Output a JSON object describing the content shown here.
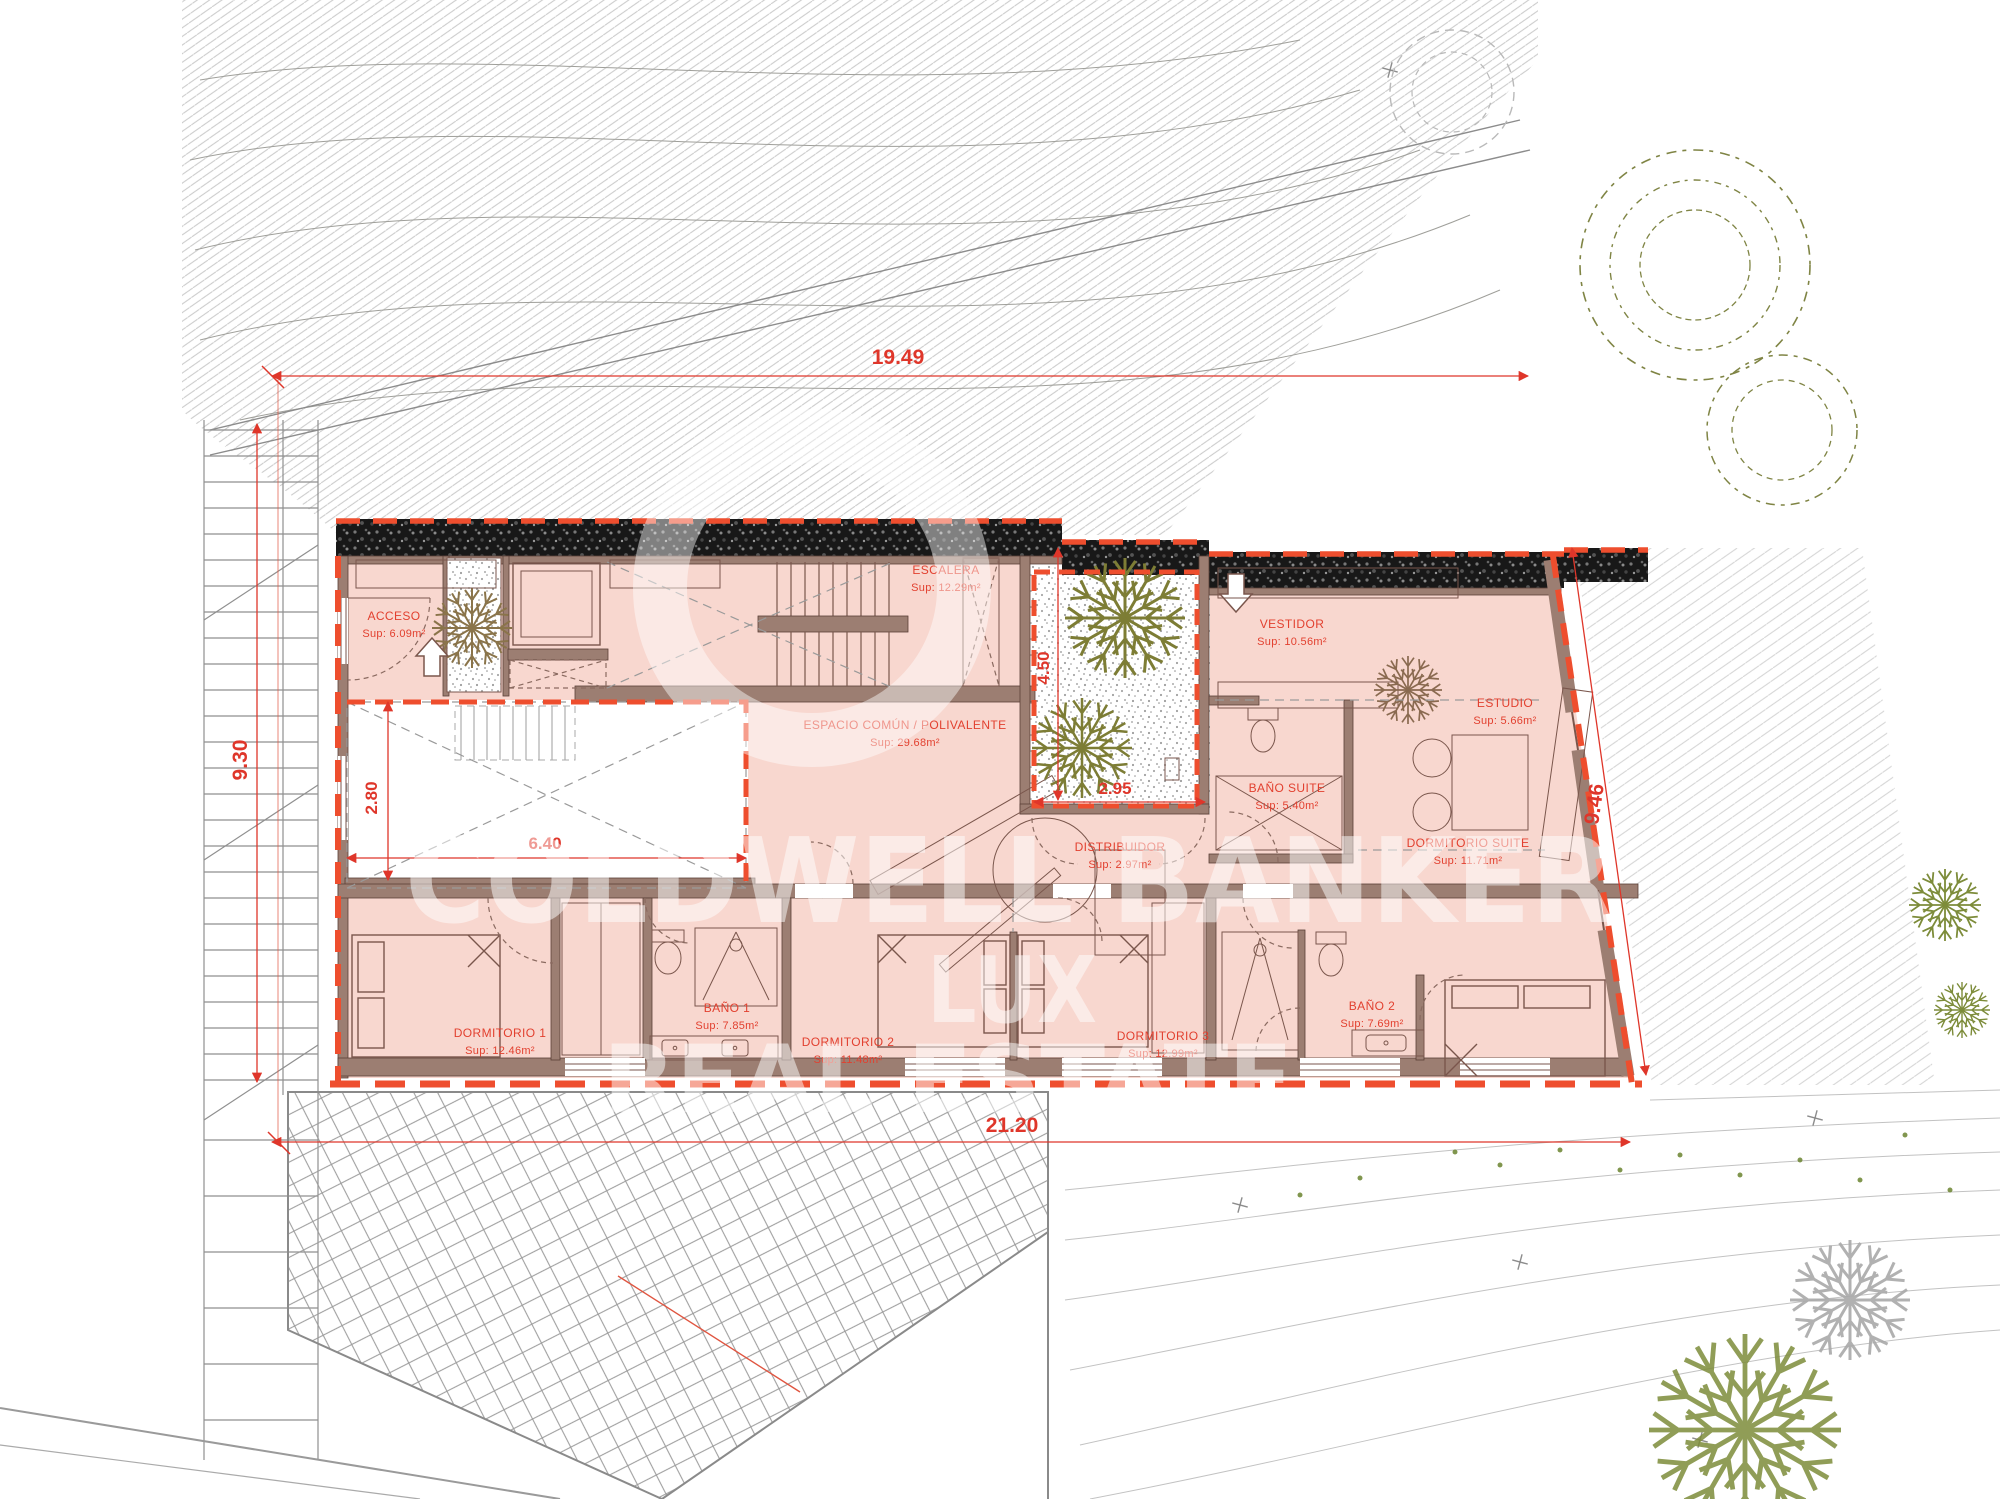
{
  "plan": {
    "watermark": {
      "line1": "COLDWELL BANKER",
      "line2": "LUX",
      "line3": "REAL ESTATE"
    },
    "rooms": [
      {
        "name": "ACCESO",
        "sup": "Sup: 6.09m²"
      },
      {
        "name": "ESCALERA",
        "sup": "Sup: 12.29m²"
      },
      {
        "name": "ESPACIO COMÚN / POLIVALENTE",
        "sup": "Sup: 29.68m²"
      },
      {
        "name": "VESTIDOR",
        "sup": "Sup: 10.56m²"
      },
      {
        "name": "ESTUDIO",
        "sup": "Sup: 5.66m²"
      },
      {
        "name": "BAÑO SUITE",
        "sup": "Sup: 5.40m²"
      },
      {
        "name": "DORMITORIO SUITE",
        "sup": "Sup: 11.71m²"
      },
      {
        "name": "DISTRIBUIDOR",
        "sup": "Sup: 2.97m²"
      },
      {
        "name": "DORMITORIO 1",
        "sup": "Sup: 12.46m²"
      },
      {
        "name": "BAÑO 1",
        "sup": "Sup: 7.85m²"
      },
      {
        "name": "DORMITORIO 2",
        "sup": "Sup: 11.48m²"
      },
      {
        "name": "DORMITORIO 3",
        "sup": "Sup: 12.99m²"
      },
      {
        "name": "BAÑO 2",
        "sup": "Sup: 7.69m²"
      }
    ],
    "dimensions": {
      "top": "19.49",
      "left": "9.30",
      "void_width": "6.40",
      "void_height": "2.80",
      "patio_height": "4.50",
      "patio_width": "2.95",
      "right": "9.46",
      "bottom": "21.20"
    },
    "colors": {
      "outline_red": "#ee4e2e",
      "label_red": "#e2402f",
      "plan_fill": "#f8d7cf",
      "wall_brown": "#9c7e72",
      "tree_olive": "#7d8440"
    }
  }
}
